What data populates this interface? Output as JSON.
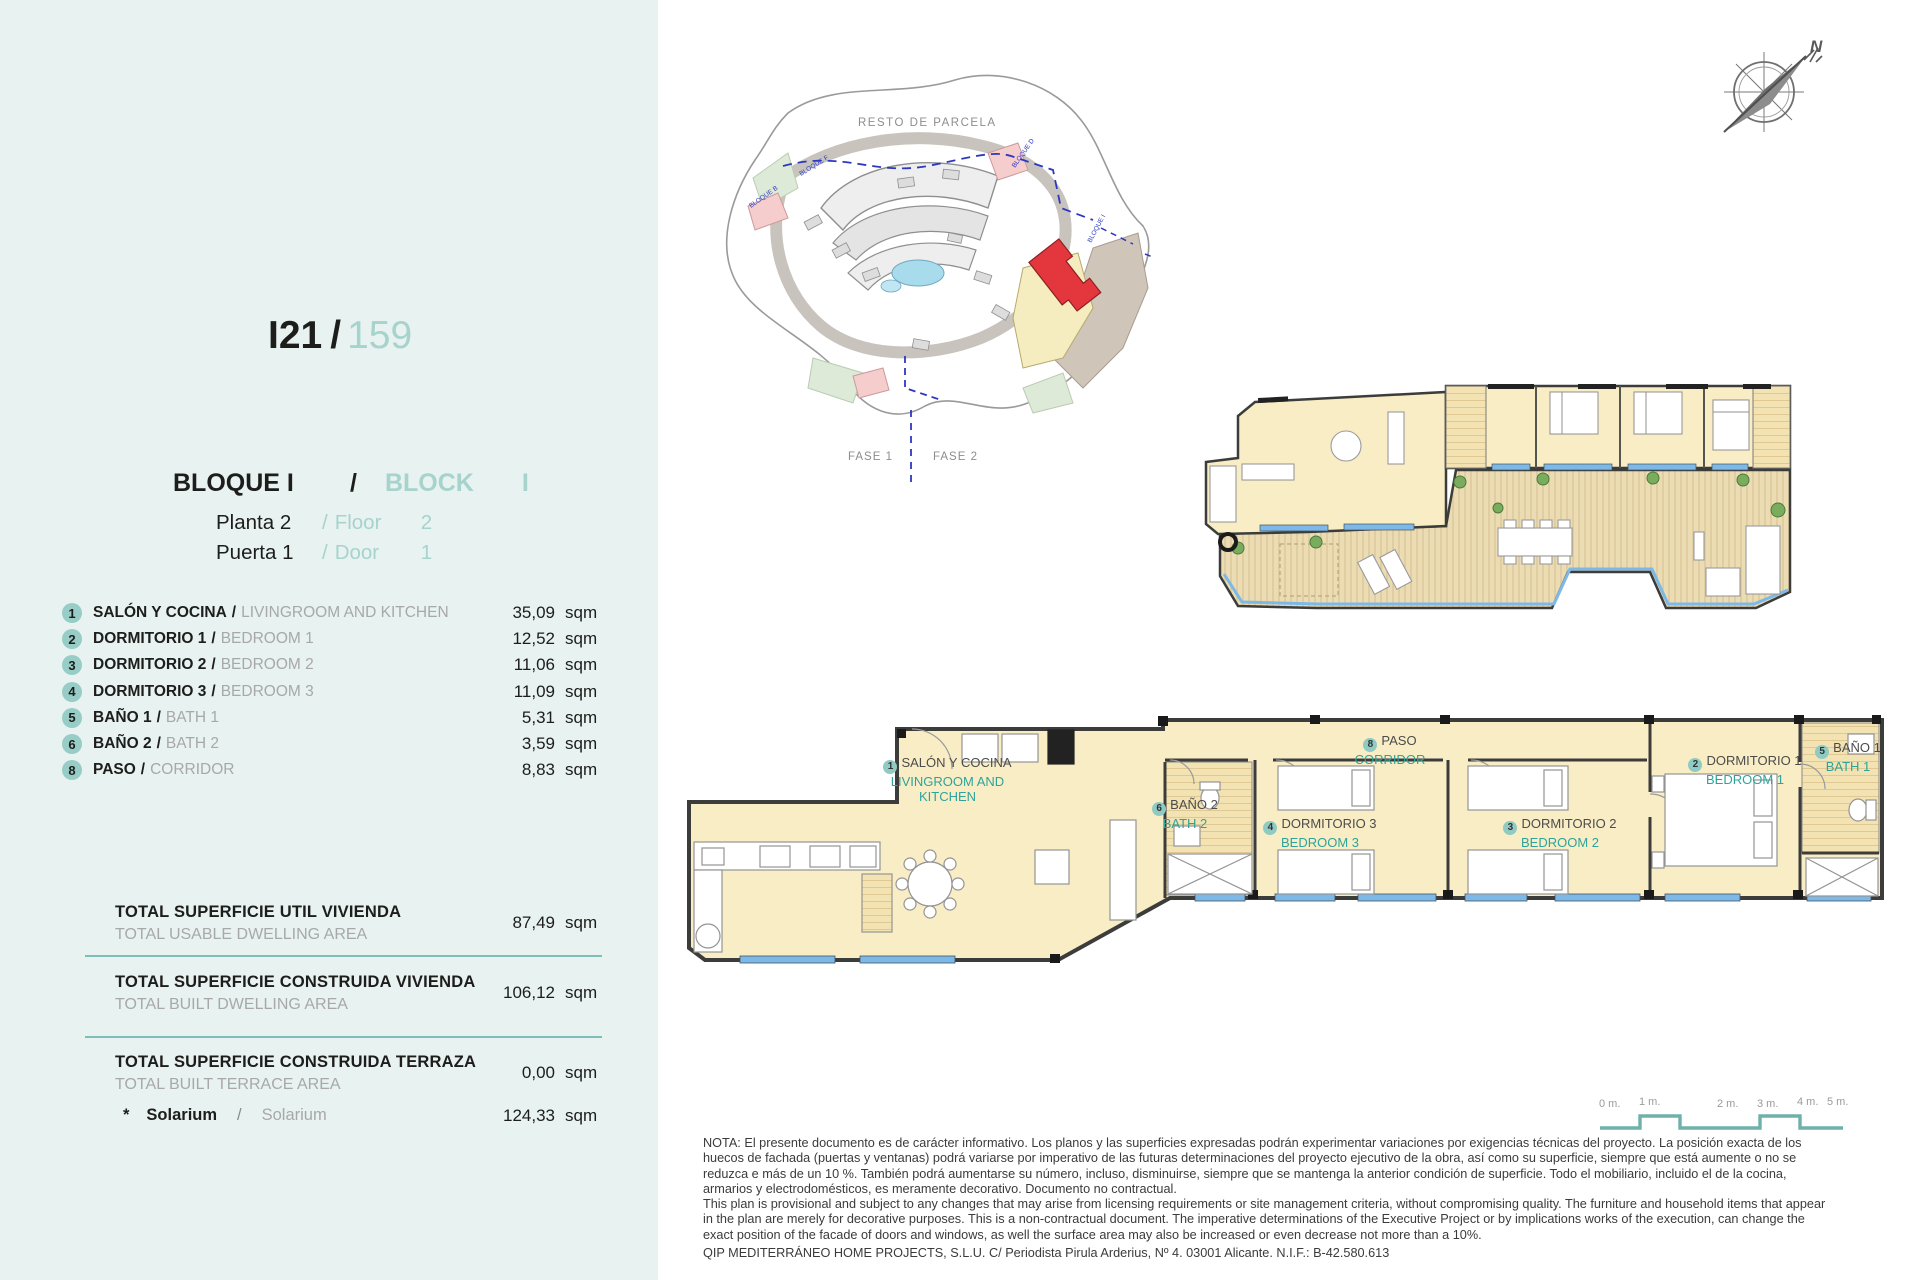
{
  "panel": {
    "title": {
      "code": "I21",
      "sep": "/",
      "number": "159"
    },
    "block": {
      "es": "BLOQUE  I",
      "sep": "/",
      "en": "BLOCK",
      "en_value": "I"
    },
    "floor": {
      "es": "Planta 2",
      "sep": "/",
      "en": "Floor",
      "en_value": "2"
    },
    "door": {
      "es": "Puerta 1",
      "sep": "/",
      "en": "Door",
      "en_value": "1"
    },
    "sep": "/",
    "unit": "sqm",
    "rooms": [
      {
        "num": "1",
        "es": "SALÓN Y COCINA",
        "en": "LIVINGROOM AND KITCHEN",
        "value": "35,09",
        "unit": "sqm"
      },
      {
        "num": "2",
        "es": "DORMITORIO 1",
        "en": "BEDROOM 1",
        "value": "12,52",
        "unit": "sqm"
      },
      {
        "num": "3",
        "es": "DORMITORIO 2",
        "en": "BEDROOM 2",
        "value": "11,06",
        "unit": "sqm"
      },
      {
        "num": "4",
        "es": "DORMITORIO 3",
        "en": "BEDROOM 3",
        "value": "11,09",
        "unit": "sqm"
      },
      {
        "num": "5",
        "es": "BAÑO 1",
        "en": "BATH 1",
        "value": "5,31",
        "unit": "sqm"
      },
      {
        "num": "6",
        "es": "BAÑO 2",
        "en": "BATH 2",
        "value": "3,59",
        "unit": "sqm"
      },
      {
        "num": "8",
        "es": "PASO",
        "en": "CORRIDOR",
        "value": "8,83",
        "unit": "sqm"
      }
    ],
    "totals": [
      {
        "es": "TOTAL SUPERFICIE UTIL VIVIENDA",
        "en": "TOTAL USABLE DWELLING AREA",
        "value": "87,49",
        "unit": "sqm"
      },
      {
        "es": "TOTAL SUPERFICIE CONSTRUIDA VIVIENDA",
        "en": "TOTAL BUILT DWELLING AREA",
        "value": "106,12",
        "unit": "sqm"
      },
      {
        "es": "TOTAL SUPERFICIE CONSTRUIDA TERRAZA",
        "en": "TOTAL BUILT TERRACE AREA",
        "value": "0,00",
        "unit": "sqm"
      }
    ],
    "solarium": {
      "star": "*",
      "es": "Solarium",
      "sep": "/",
      "en": "Solarium",
      "value": "124,33",
      "unit": "sqm"
    }
  },
  "site_plan": {
    "resto": "RESTO DE PARCELA",
    "fase1": "FASE 1",
    "fase2": "FASE 2",
    "bloques": [
      "BLOQUE B",
      "BLOQUE F",
      "BLOQUE D",
      "BLOQUE I"
    ]
  },
  "compass": {
    "north": "N"
  },
  "plan_labels": [
    {
      "num": "1",
      "es": "SALÓN Y COCINA",
      "en": "LIVINGROOM AND KITCHEN"
    },
    {
      "num": "6",
      "es": "BAÑO 2",
      "en": "BATH 2"
    },
    {
      "num": "8",
      "es": "PASO",
      "en": "CORRIDOR"
    },
    {
      "num": "4",
      "es": "DORMITORIO 3",
      "en": "BEDROOM 3"
    },
    {
      "num": "3",
      "es": "DORMITORIO 2",
      "en": "BEDROOM 2"
    },
    {
      "num": "2",
      "es": "DORMITORIO 1",
      "en": "BEDROOM 1"
    },
    {
      "num": "5",
      "es": "BAÑO 1",
      "en": "BATH 1"
    }
  ],
  "scale_bar": {
    "labels": [
      "0 m.",
      "1 m.",
      "2 m.",
      "3 m.",
      "4 m.",
      "5 m."
    ]
  },
  "nota": {
    "es": "NOTA: El presente documento es de carácter informativo. Los planos y las superficies expresadas podrán experimentar variaciones por exigencias técnicas del proyecto. La posición exacta de los huecos de fachada (puertas y ventanas) podrá variarse por imperativo de las futuras determinaciones del proyecto ejecutivo de la obra, así como su superficie, siempre que está aumente o no se reduzca e más de un 10 %. También podrá aumentarse su número, incluso, disminuirse, siempre que se mantenga la anterior condición de superficie. Todo el mobiliario, incluido el de la cocina, armarios y electrodomésticos, es meramente decorativo. Documento no contractual.",
    "en": "This plan is provisional and subject to any changes that may arise from licensing requirements or site management criteria, without compromising quality. The furniture and household items that appear in the plan are merely for decorative purposes. This is a non-contractual document. The imperative determinations of the Executive Project or by implications works of the execution, can change the exact position of the facade of doors and windows, as well the surface area may also be increased or even decrease not more than a 10%.",
    "company": "QIP MEDITERRÁNEO HOME PROJECTS, S.L.U. C/ Periodista Pirula Arderius, Nº 4. 03001 Alicante. N.I.F.: B-42.580.613"
  },
  "colors": {
    "panel_bg": "#e7f2f1",
    "accent_teal": "#97cdc6",
    "teal_text": "#2fa39b",
    "room_cream": "#f9edc5",
    "deck_wood": "#ecdcb4",
    "sill_blue": "#7cb9e8",
    "wall": "#3c3c3b",
    "highlight_red": "#e4373d",
    "boundary_blue": "#2d38c0"
  }
}
